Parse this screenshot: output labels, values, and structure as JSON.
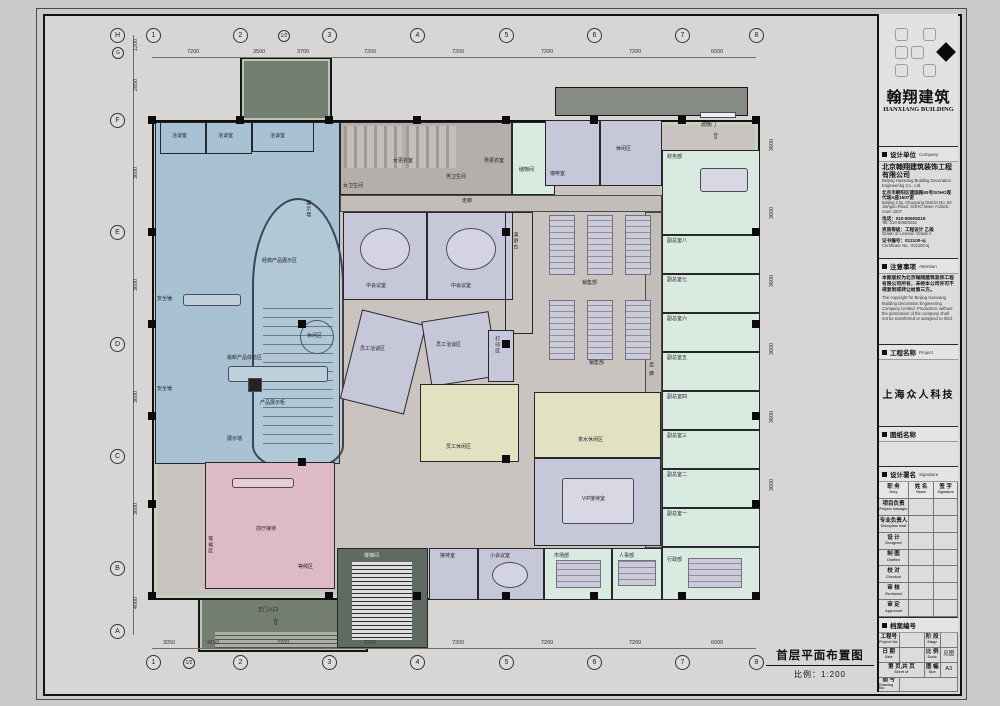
{
  "icons": {
    "up_arrow": "⇧"
  },
  "titleblock": {
    "logo": {
      "cn": "翰翔建筑",
      "en": "HANXIANG BUILDING"
    },
    "company": {
      "header_cn": "设计单位",
      "header_en": "Company",
      "name_cn": "北京翰翔建筑装饰工程有限公司",
      "name_en": "Beijing Hanxiang Building Decoration Engineering Co., Ltd.",
      "addr_cn": "北京市朝阳区建国路93号SOHO现代城A座1507室",
      "addr_en": "Beijing City, Chaoyang District No. 93 Jianguo Road, SOHO tower A block, room 1507",
      "tel_cn": "电话：010-80609216",
      "tel_en": "Tel: 010-80609216",
      "grade_cn": "资质等级：工程设计 乙级",
      "grade_en": "Grade of License: Grade A",
      "cert_cn": "证书编号：012100-sj",
      "cert_en": "Certificate No.: 012100-sj"
    },
    "attention": {
      "header_cn": "注意事项",
      "header_en": "Attention",
      "text_cn": "本图版权为北京翰翔建筑装饰工程有限公司所有，未经本公司许可不得复制或转让给第三方。",
      "text_en": "The copyright for Beijing Hanxiang Building Decoration Engineering Company Limited. Production, without the permission of the company shall not be transferred or assigned to third."
    },
    "project": {
      "header_cn": "工程名称",
      "header_en": "Project",
      "name": "上海众人科技"
    },
    "drawing_name": {
      "header_cn": "图纸名称"
    },
    "signature": {
      "header_cn": "设计署名",
      "header_en": "Signature",
      "cols": [
        {
          "cn": "职 务",
          "en": "Duty"
        },
        {
          "cn": "姓 名",
          "en": "Name"
        },
        {
          "cn": "签 字",
          "en": "Signature"
        }
      ],
      "rows": [
        {
          "cn": "项目负责",
          "en": "Project manager"
        },
        {
          "cn": "专业负责人",
          "en": "Discipline lead"
        },
        {
          "cn": "设  计",
          "en": "Designed"
        },
        {
          "cn": "制  图",
          "en": "Drafted"
        },
        {
          "cn": "校  对",
          "en": "Checked"
        },
        {
          "cn": "审  核",
          "en": "Reviewed"
        },
        {
          "cn": "审  定",
          "en": "Approved"
        }
      ]
    },
    "archive": {
      "header_cn": "档案编号",
      "project_no": {
        "cn": "工程号",
        "en": "Project No."
      },
      "stage": {
        "cn": "阶 段",
        "en": "Stage"
      },
      "date": {
        "cn": "日 期",
        "en": "Date"
      },
      "scale": {
        "cn": "比 例",
        "en": "Scale",
        "val": "见图"
      },
      "sheet": {
        "cn": "第 页,共 页",
        "en": "Sheet of"
      },
      "size": {
        "cn": "图 幅",
        "en": "Size",
        "val": "A3"
      },
      "dwg": {
        "cn": "图 号",
        "en": "Drawing No."
      }
    }
  },
  "plan": {
    "title": "首层平面布置图",
    "scale": "比例：1:200",
    "grid": {
      "bubbles_top": [
        "1",
        "2",
        "1/2",
        "3",
        "4",
        "5",
        "6",
        "7",
        "8"
      ],
      "bubbles_bottom": [
        "1",
        "1/2",
        "2",
        "3",
        "4",
        "5",
        "6",
        "7",
        "8"
      ],
      "bubbles_left": [
        "H",
        "G",
        "F",
        "E",
        "D",
        "C",
        "B",
        "A"
      ],
      "dims_top": [
        "7200",
        "3500",
        "3700",
        "7200",
        "7200",
        "7200",
        "7200",
        "6000"
      ],
      "dims_bottom": [
        "3050",
        "4150",
        "7200",
        "7200",
        "7200",
        "7200",
        "7200",
        "6000"
      ],
      "dims_left": [
        "1200",
        "2850",
        "3600",
        "3600",
        "3600",
        "3600",
        "4000"
      ],
      "dims_right": [
        "3600",
        "3600",
        "3600",
        "3600",
        "3600",
        "3600"
      ]
    },
    "annotations": [
      "洽谈室",
      "洽谈室",
      "洽谈室",
      "展示墙",
      "休闲区",
      "最新产品体验区",
      "产品展示柜",
      "展示墙",
      "经典产品展示区",
      "安全锤",
      "安全锤",
      "女卫生间",
      "女更衣室",
      "男卫生间",
      "男更衣室",
      "储物间",
      "走廊",
      "咖啡室",
      "休闲区",
      "疏散门",
      "财务部",
      "副总室八",
      "副总室七",
      "副总室六",
      "副总室五",
      "副总室四",
      "副总室三",
      "副总室二",
      "副总室一",
      "行政部",
      "走 廊",
      "中会议室",
      "中会议室",
      "销售部",
      "销售部",
      "演讲台",
      "员工洽谈区",
      "员工洽谈区",
      "打印区",
      "员工休闲区",
      "茶水休闲区",
      "VIP接待室",
      "前厅接待",
      "等候区",
      "等候区",
      "正门入口",
      "楼梯间",
      "接待室",
      "小会议室",
      "市场部",
      "人事部"
    ]
  }
}
